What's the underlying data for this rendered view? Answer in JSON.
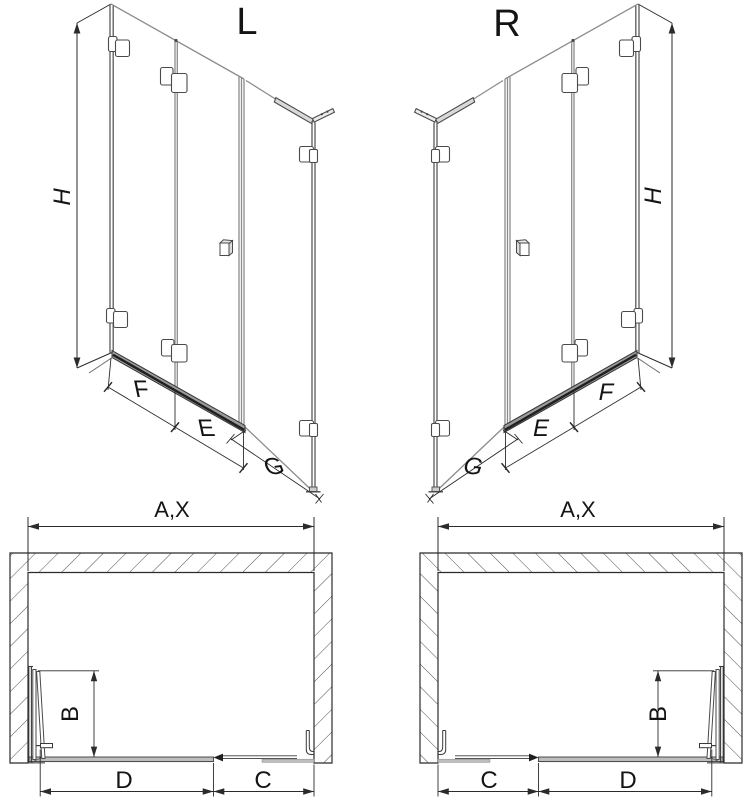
{
  "document": {
    "type": "technical-drawing",
    "background": "#ffffff"
  },
  "colors": {
    "glass_line": "#8c8c8c",
    "frame_line": "#4a4a4a",
    "dim_line": "#2b2b2b",
    "text": "#141414",
    "rail_fill": "#9a9a9a",
    "rail_dark": "#222222",
    "threshold_fill": "#bdbdbd",
    "wall_line": "#2b2b2b"
  },
  "views": {
    "iso_left": {
      "title": "L",
      "h": "H",
      "f": "F",
      "e": "E",
      "g": "G"
    },
    "iso_right": {
      "title": "R",
      "h": "H",
      "f": "F",
      "e": "E",
      "g": "G"
    },
    "plan_left": {
      "width": "A,X",
      "b": "B",
      "d": "D",
      "c": "C"
    },
    "plan_right": {
      "width": "A,X",
      "b": "B",
      "d": "D",
      "c": "C"
    }
  }
}
